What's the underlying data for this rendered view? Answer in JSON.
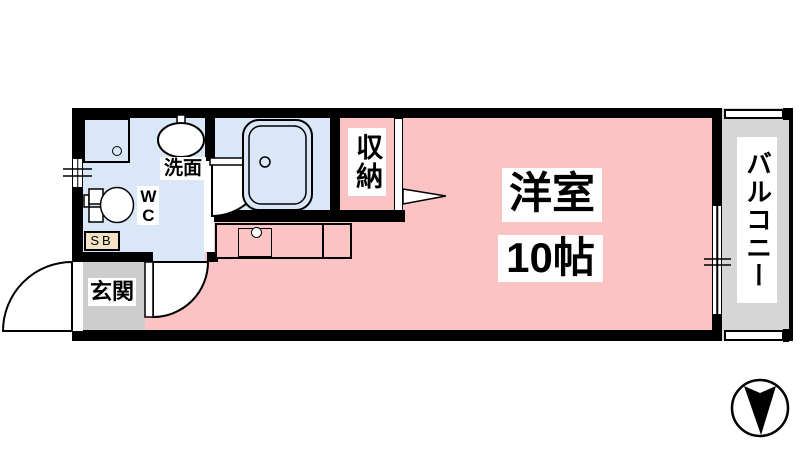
{
  "labels": {
    "main_room_name": "洋室",
    "main_room_size": "10帖",
    "closet": "収納",
    "entrance": "玄関",
    "washbasin": "洗面",
    "toilet": "WC",
    "shoe_box": "SB",
    "balcony": "バルコニー"
  },
  "compass": {
    "arrow_direction": "down"
  },
  "colors": {
    "room_pink": "#FBC3C3",
    "wet_area_blue": "#D9E7F8",
    "balcony_gray": "#D6D6D6",
    "entrance_gray": "#CDCDCD",
    "shoe_box_beige": "#F2E3C4",
    "wall_black": "#000000"
  }
}
